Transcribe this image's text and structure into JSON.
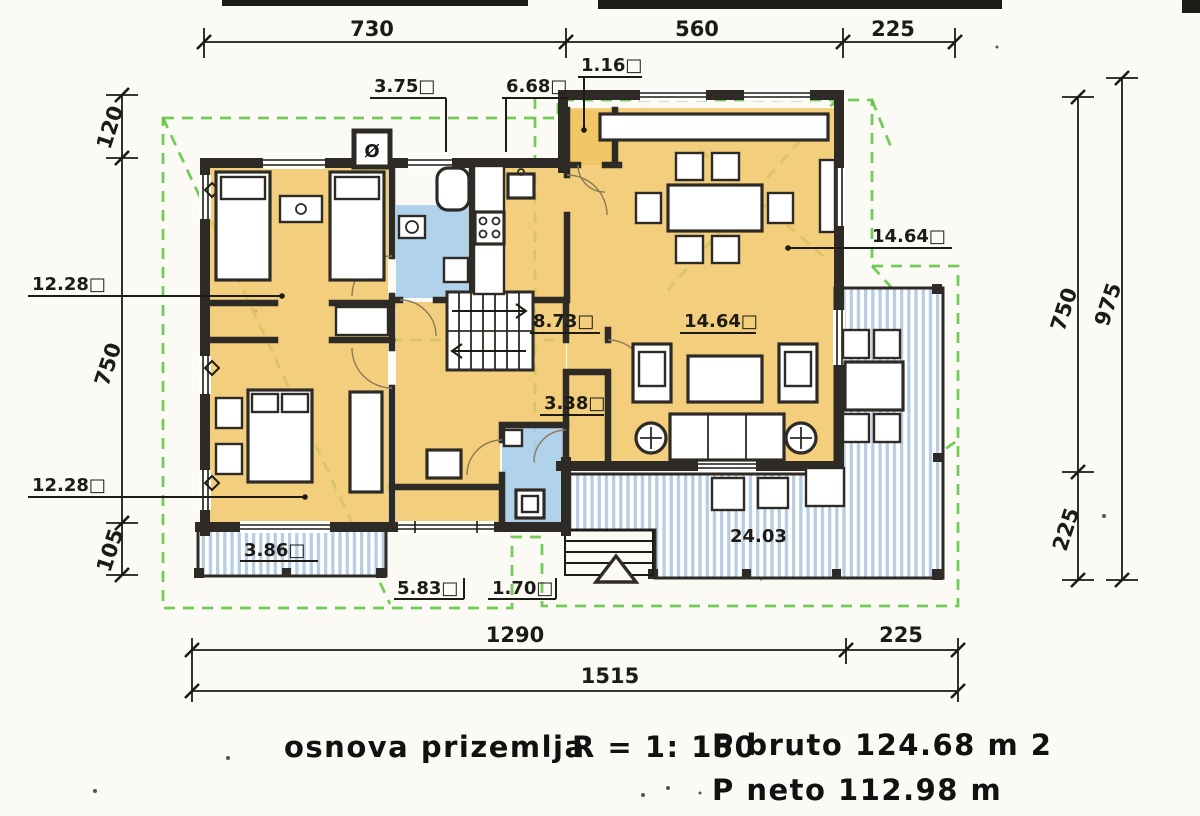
{
  "colors": {
    "paper": "#fbfaf5",
    "ink": "#1c1b16",
    "wall_dark": "#2e2b26",
    "floor_orange": "#efc463",
    "bath_blue": "#a9cdea",
    "terrace_stripe": "#b7cde4",
    "roof_green": "#5cc33c"
  },
  "dims": {
    "top": [
      "730",
      "560",
      "225"
    ],
    "bottom": [
      "1290",
      "225",
      "1515"
    ],
    "left": [
      "120",
      "750",
      "105"
    ],
    "right_inner": [
      "750",
      "225"
    ],
    "right_outer": [
      "975"
    ]
  },
  "areas": {
    "bath": "3.75□",
    "kitchen": "6.68□",
    "pantry": "1.16□",
    "dining": "14.64□",
    "bedroom_top": "12.28□",
    "bedroom_bottom": "12.28□",
    "stair_hall": "8.73□",
    "living": "14.64□",
    "corridor": "3.38□",
    "terrace_left": "3.86□",
    "porch": "5.83□",
    "entry": "1.70□",
    "terrace_main": "24.03"
  },
  "symbols": {
    "chimney_vent": "Ø"
  },
  "footer": {
    "plan_name": "osnova prizemlja",
    "scale": "R = 1: 150",
    "gross_area": "P bruto 124.68 m 2",
    "net_area": "P neto 112.98 m"
  }
}
